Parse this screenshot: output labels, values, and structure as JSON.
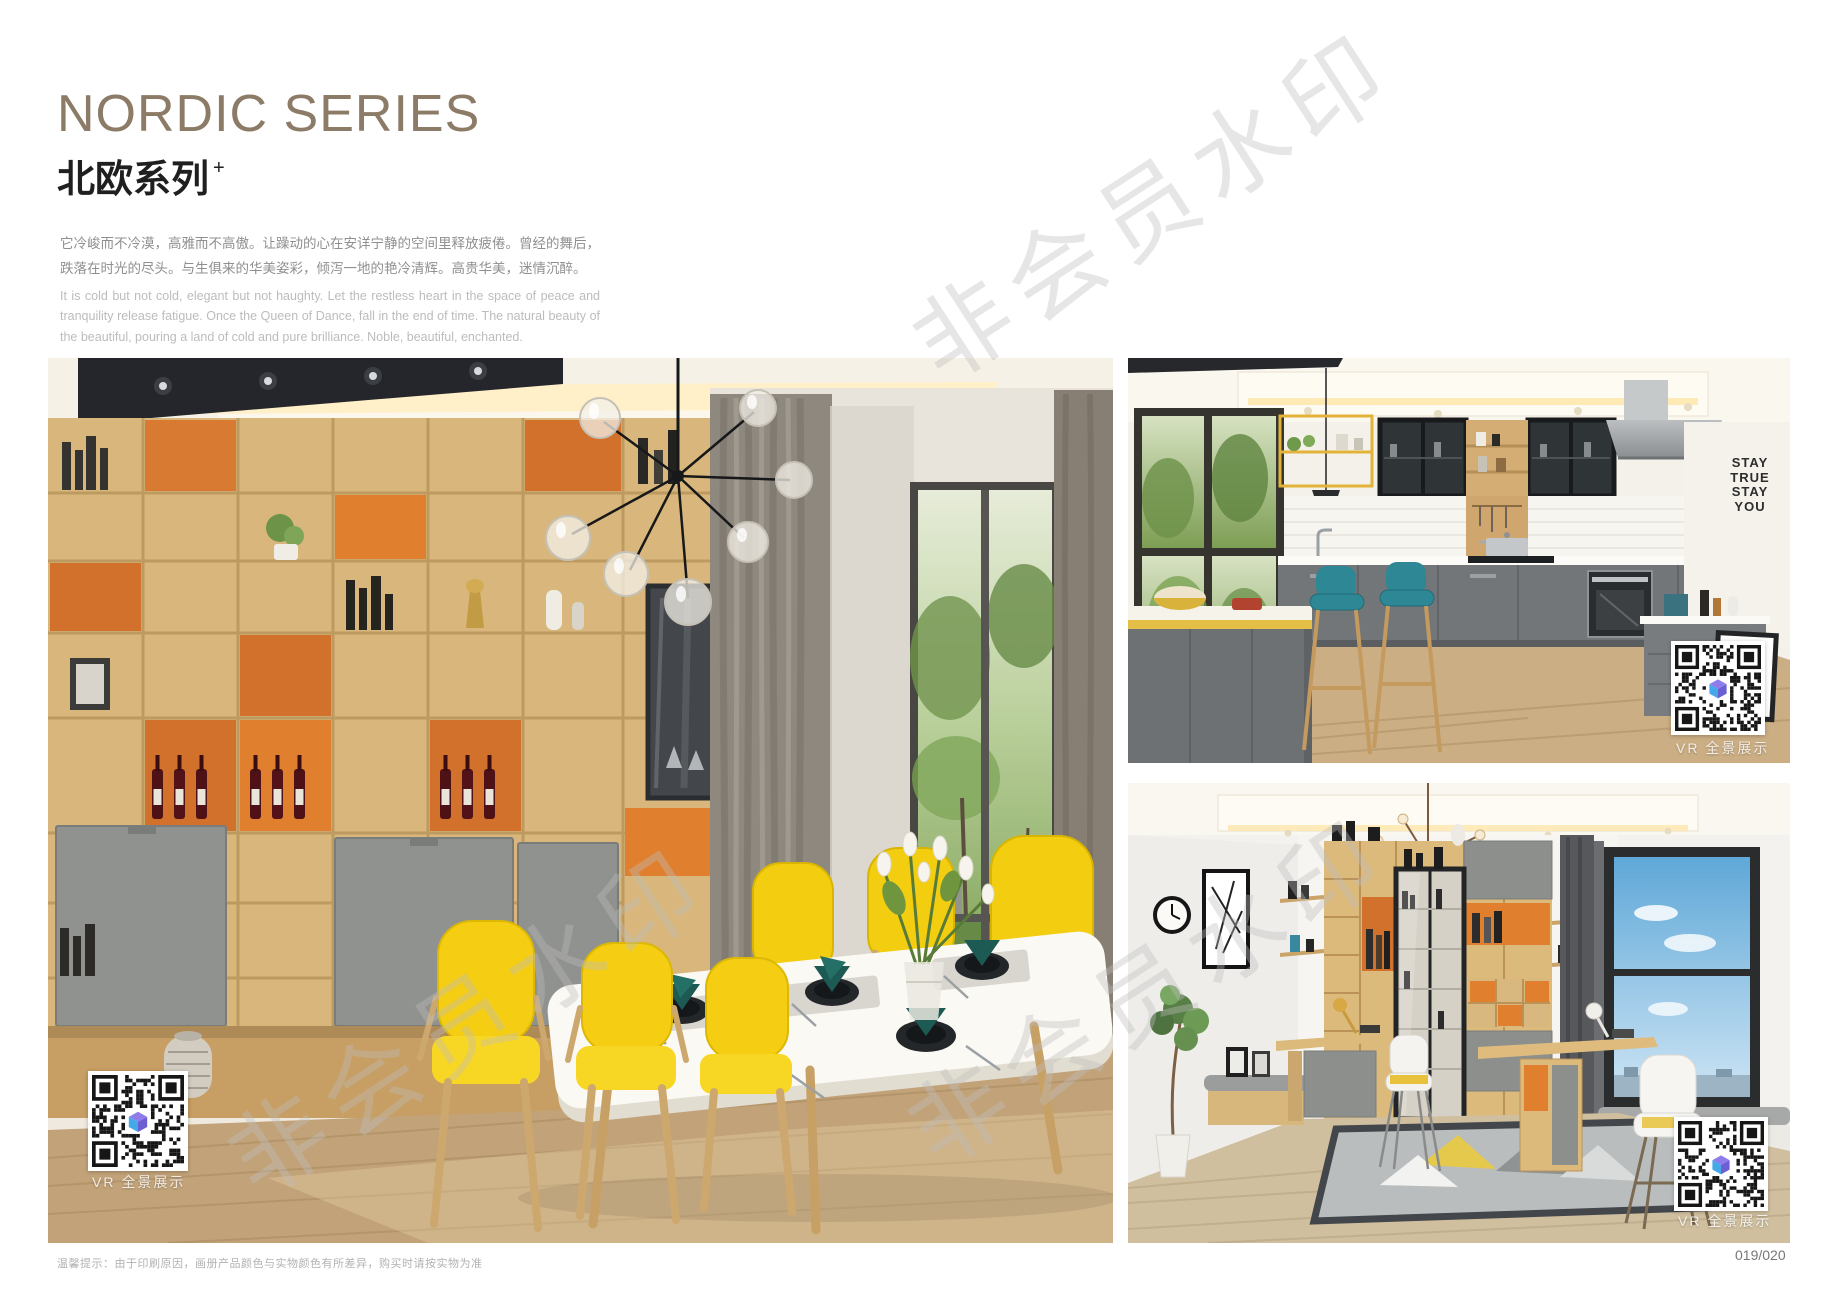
{
  "header": {
    "title_en": "NORDIC SERIES",
    "title_zh": "北欧系列",
    "title_sup": "+",
    "desc_zh": "它冷峻而不冷漠，高雅而不高傲。让躁动的心在安详宁静的空间里释放疲倦。曾经的舞后，跌落在时光的尽头。与生俱来的华美姿彩，倾泻一地的艳冷清辉。高贵华美，迷情沉醉。",
    "desc_en": "It is cold but not cold, elegant but not haughty. Let the restless heart in the space of peace and tranquility release fatigue. Once the Queen of Dance, fall in the end of time. The natural beauty of the beautiful, pouring a land of cold and pure brilliance. Noble, beautiful, enchanted."
  },
  "watermark": {
    "text": "非会员水印"
  },
  "photos": {
    "dining": {
      "vr_label": "VR 全景展示"
    },
    "kitchen": {
      "vr_label": "VR 全景展示",
      "wall_art": [
        "STAY",
        "TRUE",
        "STAY",
        "YOU"
      ]
    },
    "study": {
      "vr_label": "VR 全景展示"
    }
  },
  "footer": {
    "tip": "温馨提示：由于印刷原因，画册产品颜色与实物颜色有所差异，购买时请按实物为准",
    "page_number": "019/020"
  },
  "colors": {
    "title_brown": "#8c7b66",
    "accent_orange": "#d2712c",
    "chair_yellow": "#f5ce14",
    "stool_teal": "#2e8794",
    "napkin_teal": "#1e5a54",
    "cabinet_gray": "#8d8f8c",
    "shelf_wood": "#d9b77c"
  }
}
